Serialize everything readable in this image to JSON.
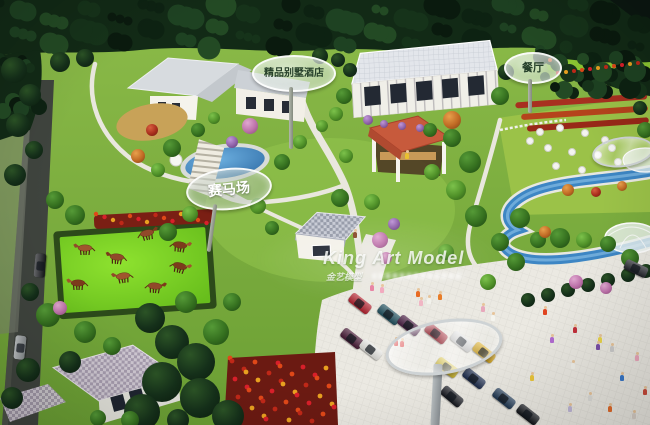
{
  "scene": {
    "description": "Aerial photograph of an architectural scale model of a resort with villas, restaurant, horse racecourse, gardens, stream and parking plaza",
    "signs": {
      "hotel_label": "精品别墅酒店",
      "restaurant_label": "餐厅",
      "racecourse_label": "赛马场"
    },
    "watermark": {
      "brand": "King Art Model",
      "brand_cn": "金艺模型"
    },
    "counts": {
      "horses": 8,
      "parked_cars": 13,
      "road_cars": 2
    },
    "palette": {
      "forest_dark": "#122a16",
      "grass": "#79ad3c",
      "paddock_green": "#7ed02a",
      "water_blue": "#3d86c4",
      "plaza": "#ebe9e2",
      "road": "#3f443e",
      "roof_gray": "#d7dbdf",
      "roof_terracotta": "#c75a3c",
      "horse_brown": "#91492a",
      "flower_red": "#b03524",
      "flower_orange": "#e08020"
    }
  }
}
